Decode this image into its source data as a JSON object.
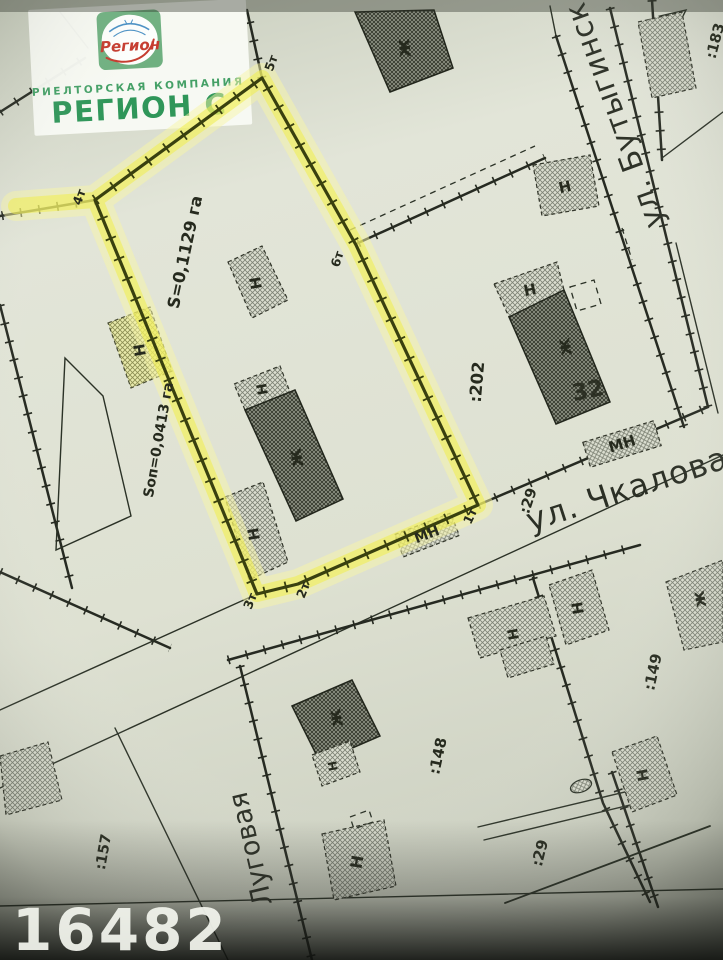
{
  "photo_id": "16482",
  "logo": {
    "script_name": "Регион",
    "tagline": "РИЕЛТОРСКАЯ КОМПАНИЯ",
    "company": "РЕГИОН С"
  },
  "map": {
    "area_total": "S=0,1129 га",
    "area_sop": "Sоп=0,0413 га",
    "house_number": "32",
    "streets": {
      "butyginskaya": "ул. Бутыгинск",
      "chkalova": "ул. Чкалова",
      "lugovaya": "Луговая"
    },
    "parcels": {
      "p202": ":202",
      "p29_road": ":29",
      "p148": ":148",
      "p149": ":149",
      "p29_south": ":29",
      "p157": ":157",
      "p183": ":183"
    },
    "points": {
      "t1": "1т",
      "t2": "2т",
      "t3": "3т",
      "t4": "4т",
      "t5": "5т",
      "t6": "6т"
    },
    "marks": {
      "residential": "ж",
      "nonresidential": "Н",
      "mn": "МН"
    }
  },
  "colors": {
    "highlight": "#f1ee4b",
    "highlight_glow": "#f7f5a8",
    "logo_green": "#2f9659",
    "logo_red": "#c53b2e",
    "paper": "#dde0d2",
    "ink": "#282c22"
  }
}
